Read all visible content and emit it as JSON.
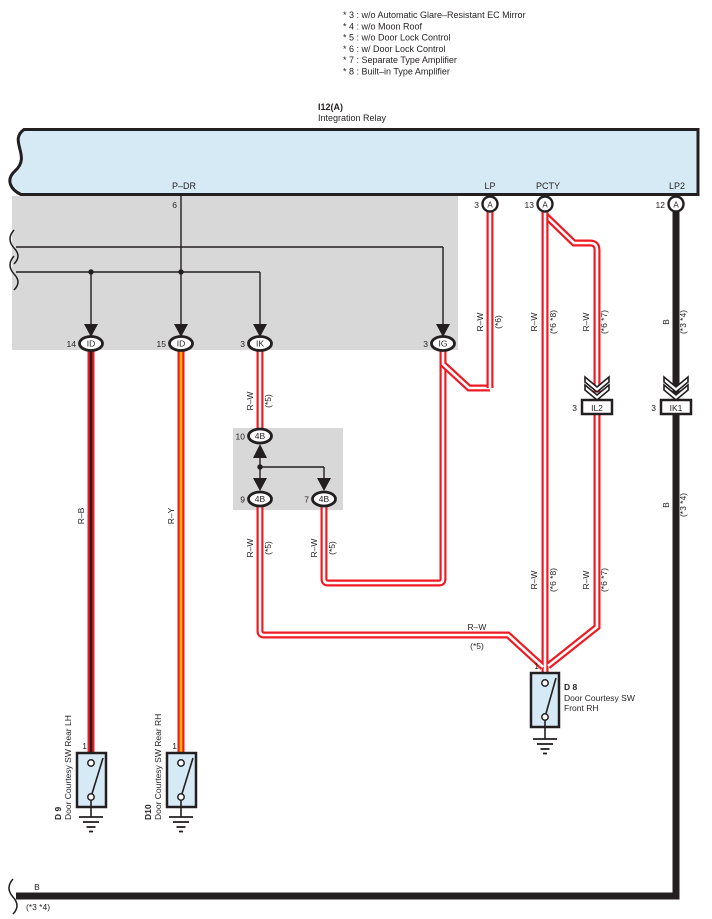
{
  "notes": [
    "* 3 : w/o Automatic Glare–Resistant EC Mirror",
    "* 4 : w/o Moon Roof",
    "* 5 : w/o Door Lock Control",
    "* 6 : w/ Door Lock Control",
    "* 7 : Separate Type Amplifier",
    "* 8 : Built–in Type Amplifier"
  ],
  "relay": {
    "code": "I12(A)",
    "name": "Integration Relay",
    "pdr": {
      "name": "P–DR",
      "pin": "6"
    },
    "lp": {
      "name": "LP",
      "pin": "3",
      "conn": "A"
    },
    "pcty": {
      "name": "PCTY",
      "pin": "13",
      "conn": "A"
    },
    "lp2": {
      "name": "LP2",
      "pin": "12",
      "conn": "A"
    }
  },
  "row_connectors": [
    {
      "pin": "14",
      "code": "ID"
    },
    {
      "pin": "15",
      "code": "ID"
    },
    {
      "pin": "3",
      "code": "IK"
    },
    {
      "pin": "3",
      "code": "IG"
    }
  ],
  "jb": [
    {
      "pin": "10",
      "code": "4B"
    },
    {
      "pin": "9",
      "code": "4B"
    },
    {
      "pin": "7",
      "code": "4B"
    }
  ],
  "inline": [
    {
      "pin": "3",
      "code": "IL2"
    },
    {
      "pin": "3",
      "code": "IK1"
    }
  ],
  "labels": {
    "rb": "R–B",
    "ry": "R–Y",
    "rw": "R–W",
    "b": "B",
    "s5": "(*5)",
    "s6": "(*6)",
    "s68": "(*6 *8)",
    "s67": "(*6 *7)",
    "s34": "(*3 *4)"
  },
  "switches": {
    "d9": {
      "code": "D 9",
      "name": "Door Courtesy SW Rear LH",
      "pin": "1"
    },
    "d10": {
      "code": "D10",
      "name": "Door Courtesy SW Rear RH",
      "pin": "1"
    },
    "d8": {
      "code": "D 8",
      "name_line1": "Door Courtesy SW",
      "name_line2": "Front RH",
      "pin": "1"
    }
  },
  "colors": {
    "wire_red": "#ed1c24",
    "wire_black": "#231f20",
    "wire_yellow": "#f9b500",
    "relay_fill": "#d6eaf6",
    "shade_gray": "#d8d8d8"
  }
}
